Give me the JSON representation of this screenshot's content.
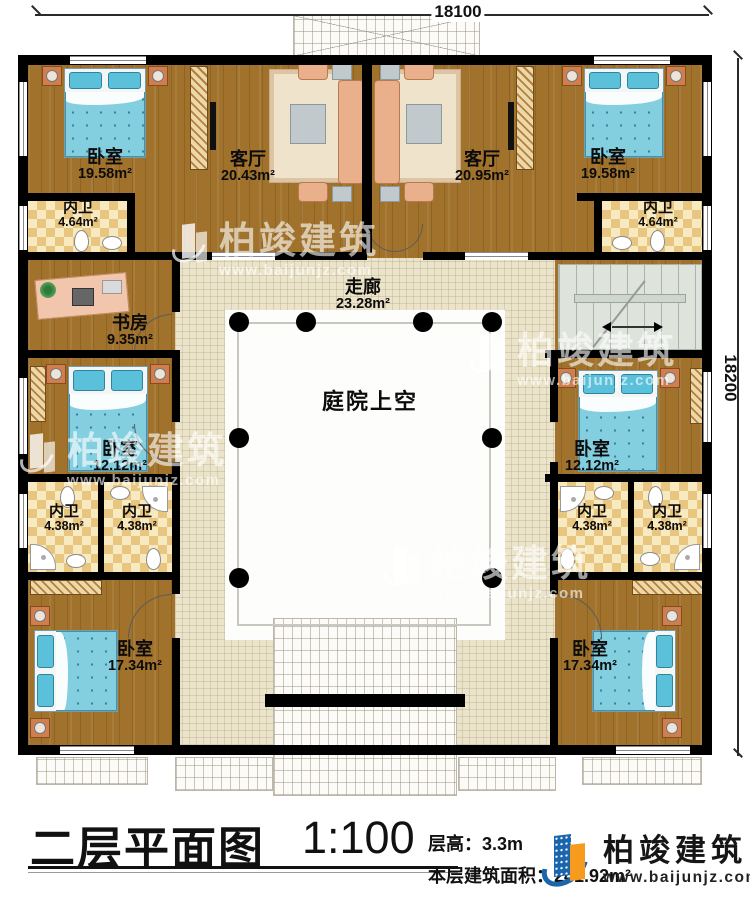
{
  "plan": {
    "dim_top": "18100",
    "dim_right": "18200"
  },
  "rooms": [
    {
      "id": "bedroom-tl",
      "name": "卧室",
      "area": "19.58m²"
    },
    {
      "id": "living-tl",
      "name": "客厅",
      "area": "20.43m²"
    },
    {
      "id": "living-tr",
      "name": "客厅",
      "area": "20.95m²"
    },
    {
      "id": "bedroom-tr",
      "name": "卧室",
      "area": "19.58m²"
    },
    {
      "id": "bath-tl",
      "name": "内卫",
      "area": "4.64m²"
    },
    {
      "id": "bath-tr",
      "name": "内卫",
      "area": "4.64m²"
    },
    {
      "id": "study",
      "name": "书房",
      "area": "9.35m²"
    },
    {
      "id": "corridor",
      "name": "走廊",
      "area": "23.28m²"
    },
    {
      "id": "bedroom-ml",
      "name": "卧室",
      "area": "12.12m²"
    },
    {
      "id": "bedroom-mr",
      "name": "卧室",
      "area": "12.12m²"
    },
    {
      "id": "courtyard",
      "name": "庭院上空",
      "area": ""
    },
    {
      "id": "bath-bl1",
      "name": "内卫",
      "area": "4.38m²"
    },
    {
      "id": "bath-bl2",
      "name": "内卫",
      "area": "4.38m²"
    },
    {
      "id": "bath-br1",
      "name": "内卫",
      "area": "4.38m²"
    },
    {
      "id": "bath-br2",
      "name": "内卫",
      "area": "4.38m²"
    },
    {
      "id": "bedroom-bl",
      "name": "卧室",
      "area": "17.34m²"
    },
    {
      "id": "bedroom-br",
      "name": "卧室",
      "area": "17.34m²"
    }
  ],
  "title_block": {
    "title": "二层平面图",
    "scale": "1:100",
    "floor_height": "层高：3.3m",
    "floor_area": "本层建筑面积：241.92m²"
  },
  "brand": {
    "name": "柏竣建筑",
    "website": "www.baijunjz.com"
  },
  "colors": {
    "wall": "#000000",
    "wood_floor": "#a0722c",
    "corridor_tile": "#ece4ca",
    "bath_checker": "#e9c67f",
    "bed_blue": "#7fcde0",
    "brand_blue": "#1b65ad",
    "brand_orange": "#f79b1e"
  }
}
